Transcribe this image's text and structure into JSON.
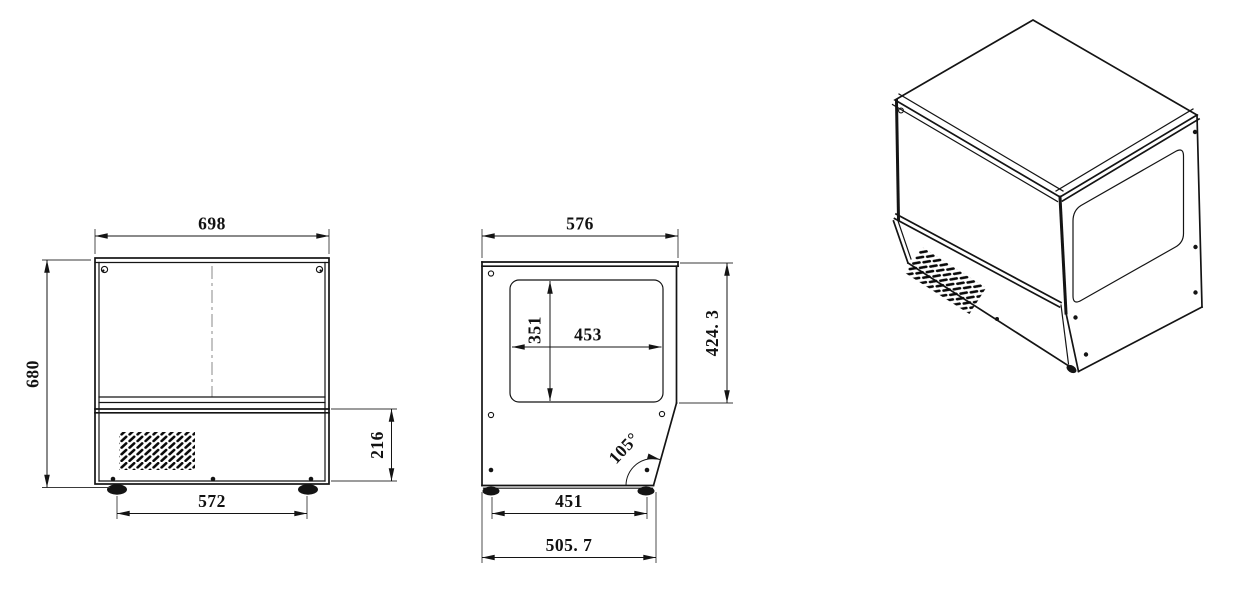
{
  "drawing": {
    "type": "engineering-dimension-drawing",
    "views": [
      "front-view",
      "side-view",
      "isometric-view"
    ]
  },
  "dims": {
    "front": {
      "top_width": "698",
      "overall_height": "680",
      "base_height": "216",
      "foot_span": "572"
    },
    "side": {
      "top_depth": "576",
      "window_height": "351",
      "window_width": "453",
      "upper_height": "424. 3",
      "front_angle": "105°",
      "foot_span": "451",
      "base_depth": "505. 7"
    }
  },
  "colors": {
    "line": "#141414",
    "background": "#ffffff"
  }
}
